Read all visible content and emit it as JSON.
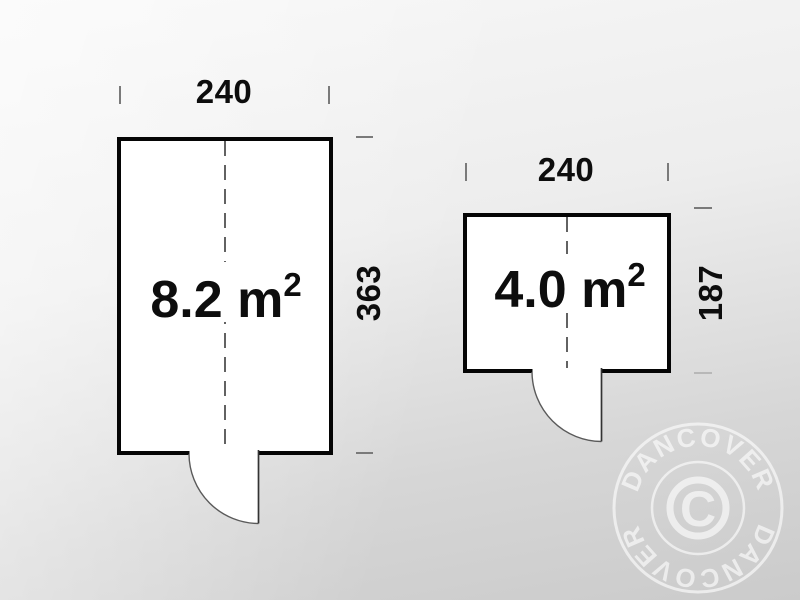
{
  "plans": [
    {
      "width_label": "240",
      "depth_label": "363",
      "area_label": "8.2 m",
      "area_exponent": "2"
    },
    {
      "width_label": "240",
      "depth_label": "187",
      "area_label": "4.0 m",
      "area_exponent": "2"
    }
  ],
  "watermark": {
    "brand_top": "DANCOVER",
    "brand_bottom": "DANCOVER",
    "copyright_letter": "C",
    "color": "#ffffff"
  },
  "colors": {
    "wall": "#050505",
    "room_fill": "#ffffff",
    "center_dash": "#2f2f2f",
    "tick": "#7a7a7a",
    "label_text": "#0d0d0d",
    "background_light": "#f7f7f7",
    "background_dark": "#cbcbcb"
  }
}
